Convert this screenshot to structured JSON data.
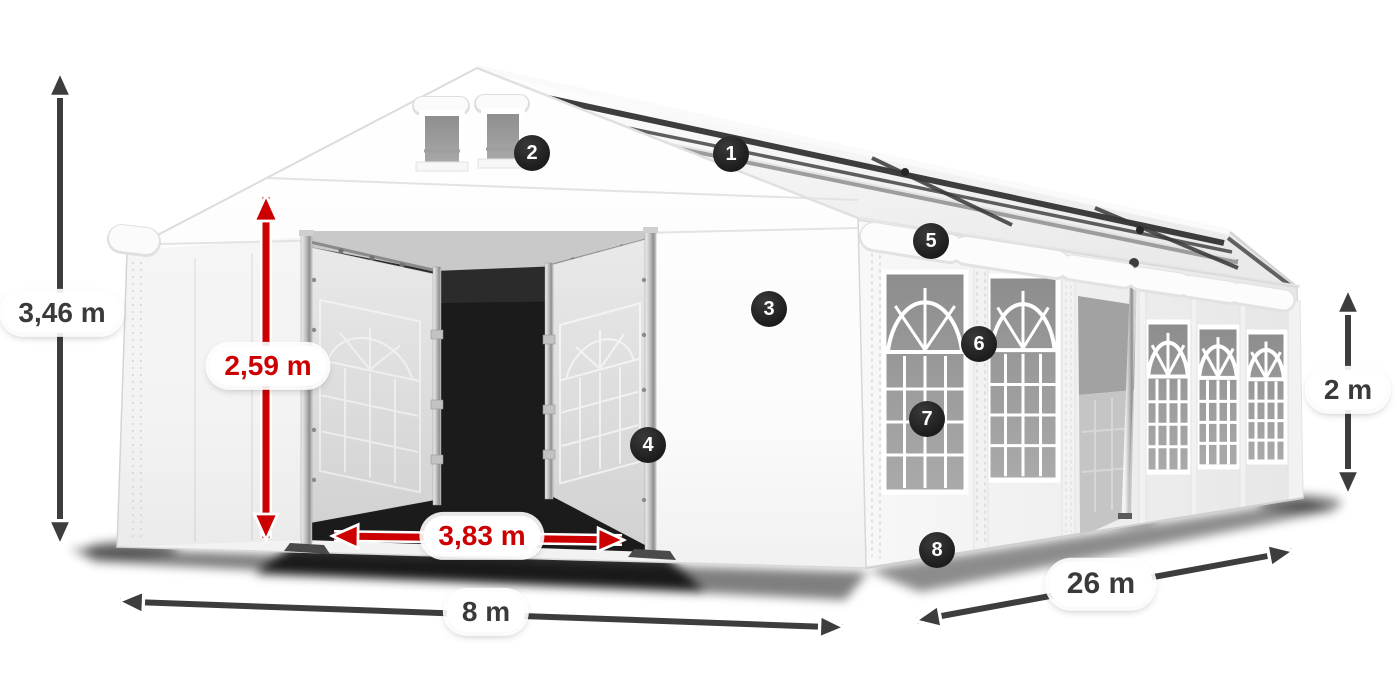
{
  "diagram": {
    "subject": "marquee-tent-dimensions"
  },
  "dimensions": {
    "total_height": "3,46 m",
    "entrance_height": "2,59 m",
    "entrance_width": "3,83 m",
    "front_width": "8 m",
    "length": "26 m",
    "side_wall_height": "2 m"
  },
  "markers": [
    {
      "number": "1"
    },
    {
      "number": "2"
    },
    {
      "number": "3"
    },
    {
      "number": "4"
    },
    {
      "number": "5"
    },
    {
      "number": "6"
    },
    {
      "number": "7"
    },
    {
      "number": "8"
    }
  ],
  "colors": {
    "dimension_red": "#cc0000",
    "dimension_dark": "#3d3d3d",
    "marker_bg": "#1c1c1c",
    "marker_text": "#ffffff",
    "pill_bg": "#ffffff",
    "pill_text": "#3a3a3a",
    "tent_outline": "#d6d6d6"
  }
}
